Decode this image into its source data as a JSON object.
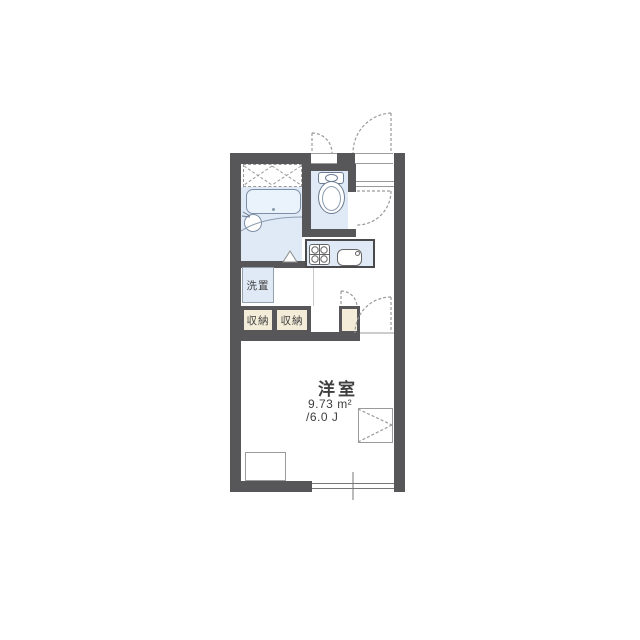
{
  "floorplan": {
    "main_room": {
      "name": "洋室",
      "area_m2": "9.73 m²",
      "area_jo": "/6.0 J"
    },
    "washer_space": {
      "label": "洗置"
    },
    "closet_left": {
      "label": "収納"
    },
    "closet_right": {
      "label": "収納"
    },
    "fixture_names": [
      "bathtub",
      "washbasin",
      "toilet",
      "kitchen-stove",
      "kitchen-sink",
      "entry-door",
      "toilet-door",
      "room-door",
      "sliding-window",
      "air-conditioner-box"
    ],
    "colors": {
      "wall": "#57575a",
      "water_area": "#e0eaf6",
      "closet_fill": "#f3ecd9",
      "outline": "#9a9a9a"
    }
  }
}
